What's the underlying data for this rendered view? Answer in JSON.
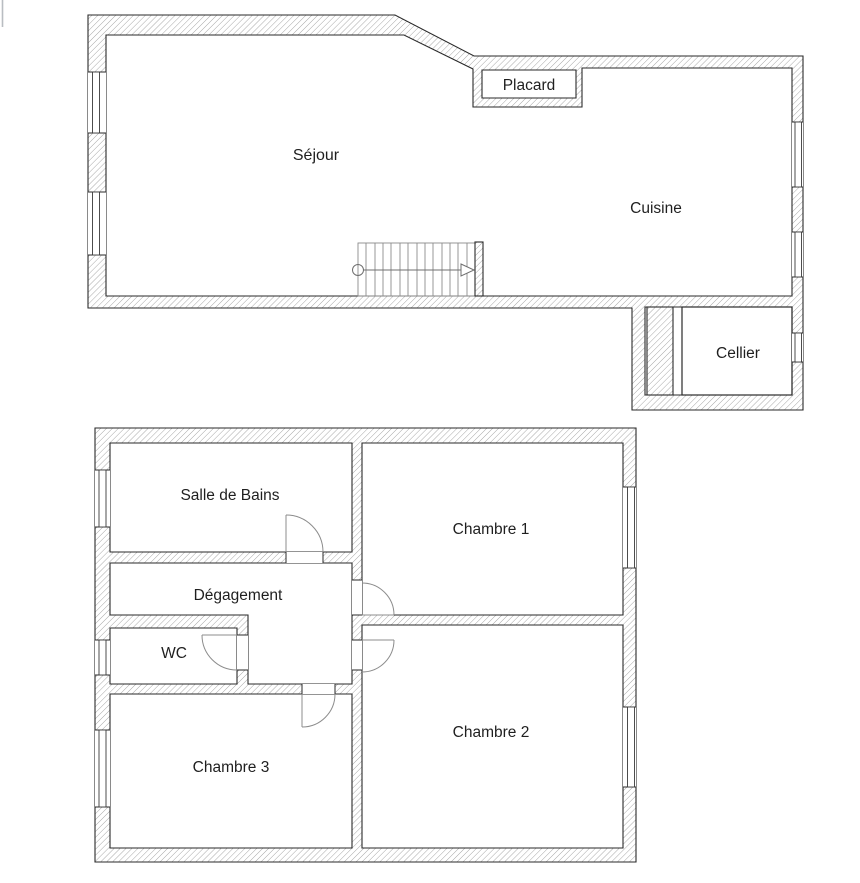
{
  "canvas": {
    "width": 860,
    "height": 883,
    "background": "#ffffff"
  },
  "palette": {
    "wall_hatch_line": "#9a9a9a",
    "wall_outline": "#2a2a2a",
    "door_swing_line": "#8c8c8c",
    "stair_line": "#6f6f6f",
    "label_color": "#1f1f1f",
    "edge_artifact": "#b9bdc2"
  },
  "upper_plan": {
    "rooms": {
      "sejour": {
        "label": "Séjour"
      },
      "cuisine": {
        "label": "Cuisine"
      },
      "placard": {
        "label": "Placard"
      },
      "cellier": {
        "label": "Cellier"
      }
    },
    "features": {
      "staircase": true,
      "window_count": 5
    }
  },
  "lower_plan": {
    "rooms": {
      "salle_de_bains": {
        "label": "Salle de Bains"
      },
      "chambre1": {
        "label": "Chambre 1"
      },
      "degagement": {
        "label": "Dégagement"
      },
      "wc": {
        "label": "WC"
      },
      "chambre3": {
        "label": "Chambre 3"
      },
      "chambre2": {
        "label": "Chambre 2"
      }
    },
    "features": {
      "door_count": 5,
      "window_count": 5
    }
  }
}
